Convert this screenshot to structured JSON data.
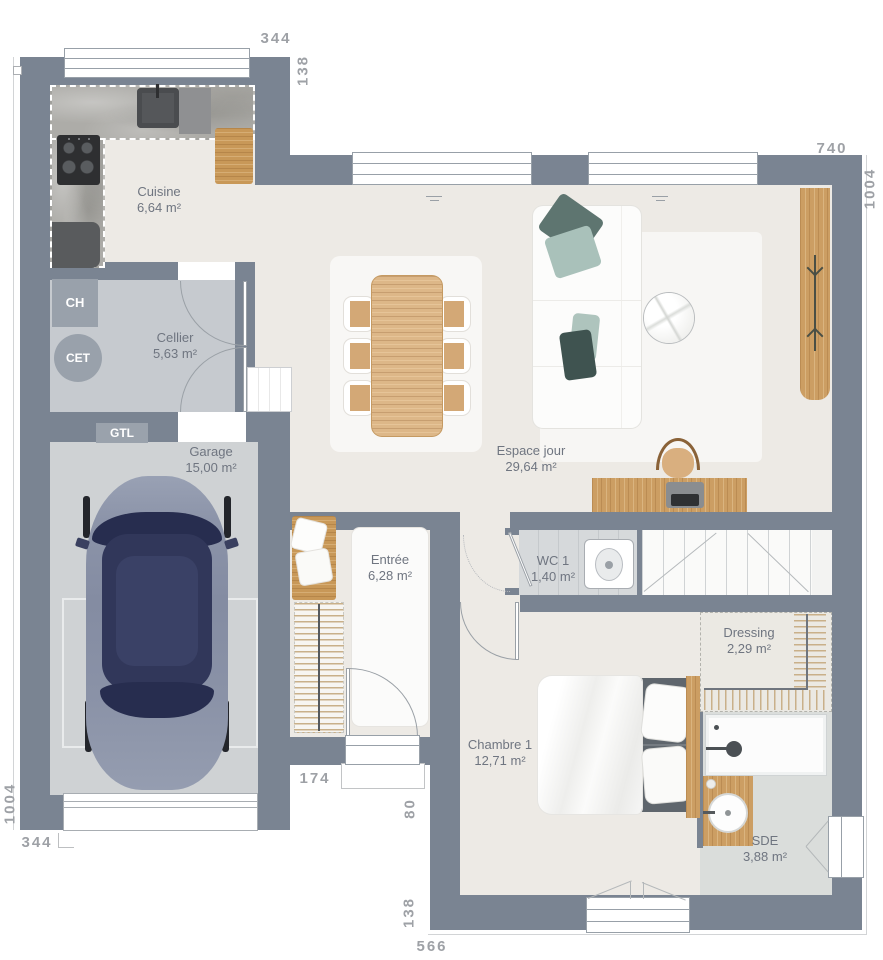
{
  "rooms": [
    {
      "name": "Cuisine",
      "area": "6,64 m²"
    },
    {
      "name": "Cellier",
      "area": "5,63 m²"
    },
    {
      "name": "Garage",
      "area": "15,00 m²"
    },
    {
      "name": "Espace jour",
      "area": "29,64 m²"
    },
    {
      "name": "Entrée",
      "area": "6,28 m²"
    },
    {
      "name": "WC 1",
      "area": "1,40 m²"
    },
    {
      "name": "Dressing",
      "area": "2,29 m²"
    },
    {
      "name": "Chambre 1",
      "area": "12,71 m²"
    },
    {
      "name": "SDE",
      "area": "3,88 m²"
    }
  ],
  "equipment": {
    "ch": "CH",
    "cet": "CET",
    "gtl": "GTL"
  },
  "dims": {
    "top_width": "344",
    "top_offset": "138",
    "right_width": "740",
    "right_height": "1004",
    "left_height": "1004",
    "left_width": "344",
    "entry_width": "174",
    "porch_depth": "80",
    "bottom_offset": "138",
    "bottom_width": "566"
  },
  "colors": {
    "wall": "#7A8492",
    "floor": "#EDEAE5",
    "floor_cellier": "#C6CACF",
    "floor_garage": "#CFD2D4",
    "wood": "#CC9E63",
    "car_body": "#8C94A9",
    "car_roof": "#31375A",
    "textile_teal": "#5E7570",
    "textile_sage": "#A9C1BA"
  }
}
